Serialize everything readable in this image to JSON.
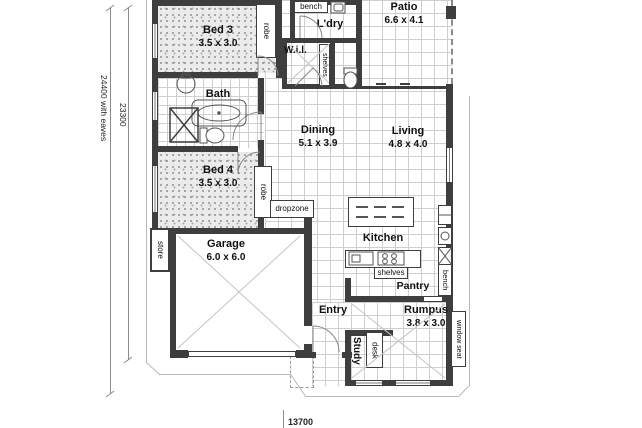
{
  "rooms": {
    "bed3": {
      "name": "Bed 3",
      "size": "3.5 x 3.0"
    },
    "bed4": {
      "name": "Bed 4",
      "size": "3.5 x 3.0"
    },
    "bath": {
      "name": "Bath"
    },
    "laundry": {
      "name": "L'dry"
    },
    "walk_in_linen": {
      "name": "W.i.l."
    },
    "patio": {
      "name": "Patio",
      "size": "6.6 x 4.1"
    },
    "dining": {
      "name": "Dining",
      "size": "5.1 x 3.9"
    },
    "living": {
      "name": "Living",
      "size": "4.8 x 4.0"
    },
    "kitchen": {
      "name": "Kitchen"
    },
    "pantry": {
      "name": "Pantry"
    },
    "garage": {
      "name": "Garage",
      "size": "6.0 x 6.0"
    },
    "entry": {
      "name": "Entry"
    },
    "rumpus": {
      "name": "Rumpus",
      "size": "3.8 x 3.0"
    },
    "study": {
      "name": "Study"
    }
  },
  "fixtures": {
    "bench_laundry": "bench",
    "bench_kitchen": "bench",
    "robe_bed3": "robe",
    "robe_bed4": "robe",
    "shelves_linen": "shelves",
    "shelves_kitchen": "shelves",
    "store": "store",
    "dropzone": "dropzone",
    "desk": "desk",
    "window_seat": "window seat"
  },
  "dimensions": {
    "left_outer": "24400 with eaves",
    "left_inner": "23300",
    "bottom": "13700"
  },
  "colors": {
    "wall": "#3e3e3e",
    "tile_grid": "#cfcfcf",
    "carpet": "#ebebeb",
    "linework": "#777777"
  }
}
